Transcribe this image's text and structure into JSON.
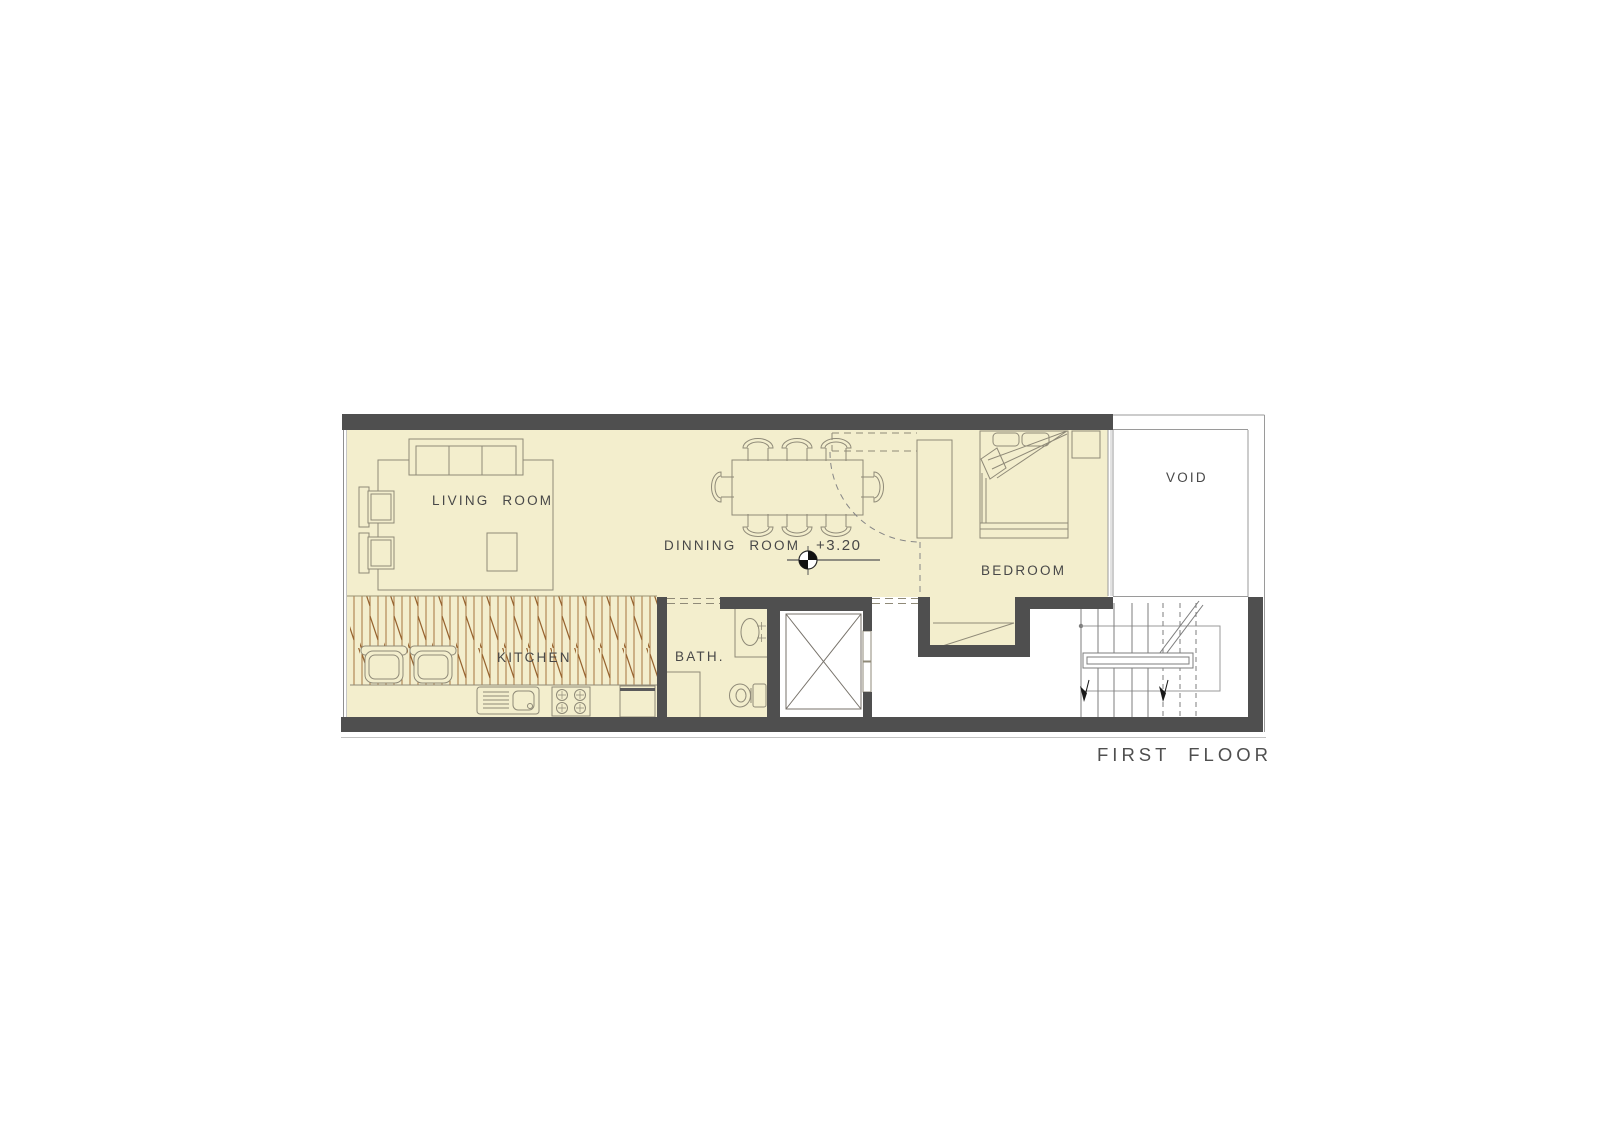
{
  "drawing": {
    "type": "architectural floor plan",
    "title": "FIRST FLOOR",
    "level_marker": "+3.20",
    "rooms": {
      "living": "LIVING ROOM",
      "dining": "DINNING ROOM",
      "kitchen": "KITCHEN",
      "bath": "BATH.",
      "bedroom": "BEDROOM",
      "void": "VOID"
    },
    "colors": {
      "wall": "#4f4f4f",
      "floor_fill": "#f3eecd",
      "kitchen_hatch": "#a5743f",
      "furniture_line": "#8f8a78",
      "thin_outline": "#9a9a9a",
      "text": "#484848"
    }
  }
}
